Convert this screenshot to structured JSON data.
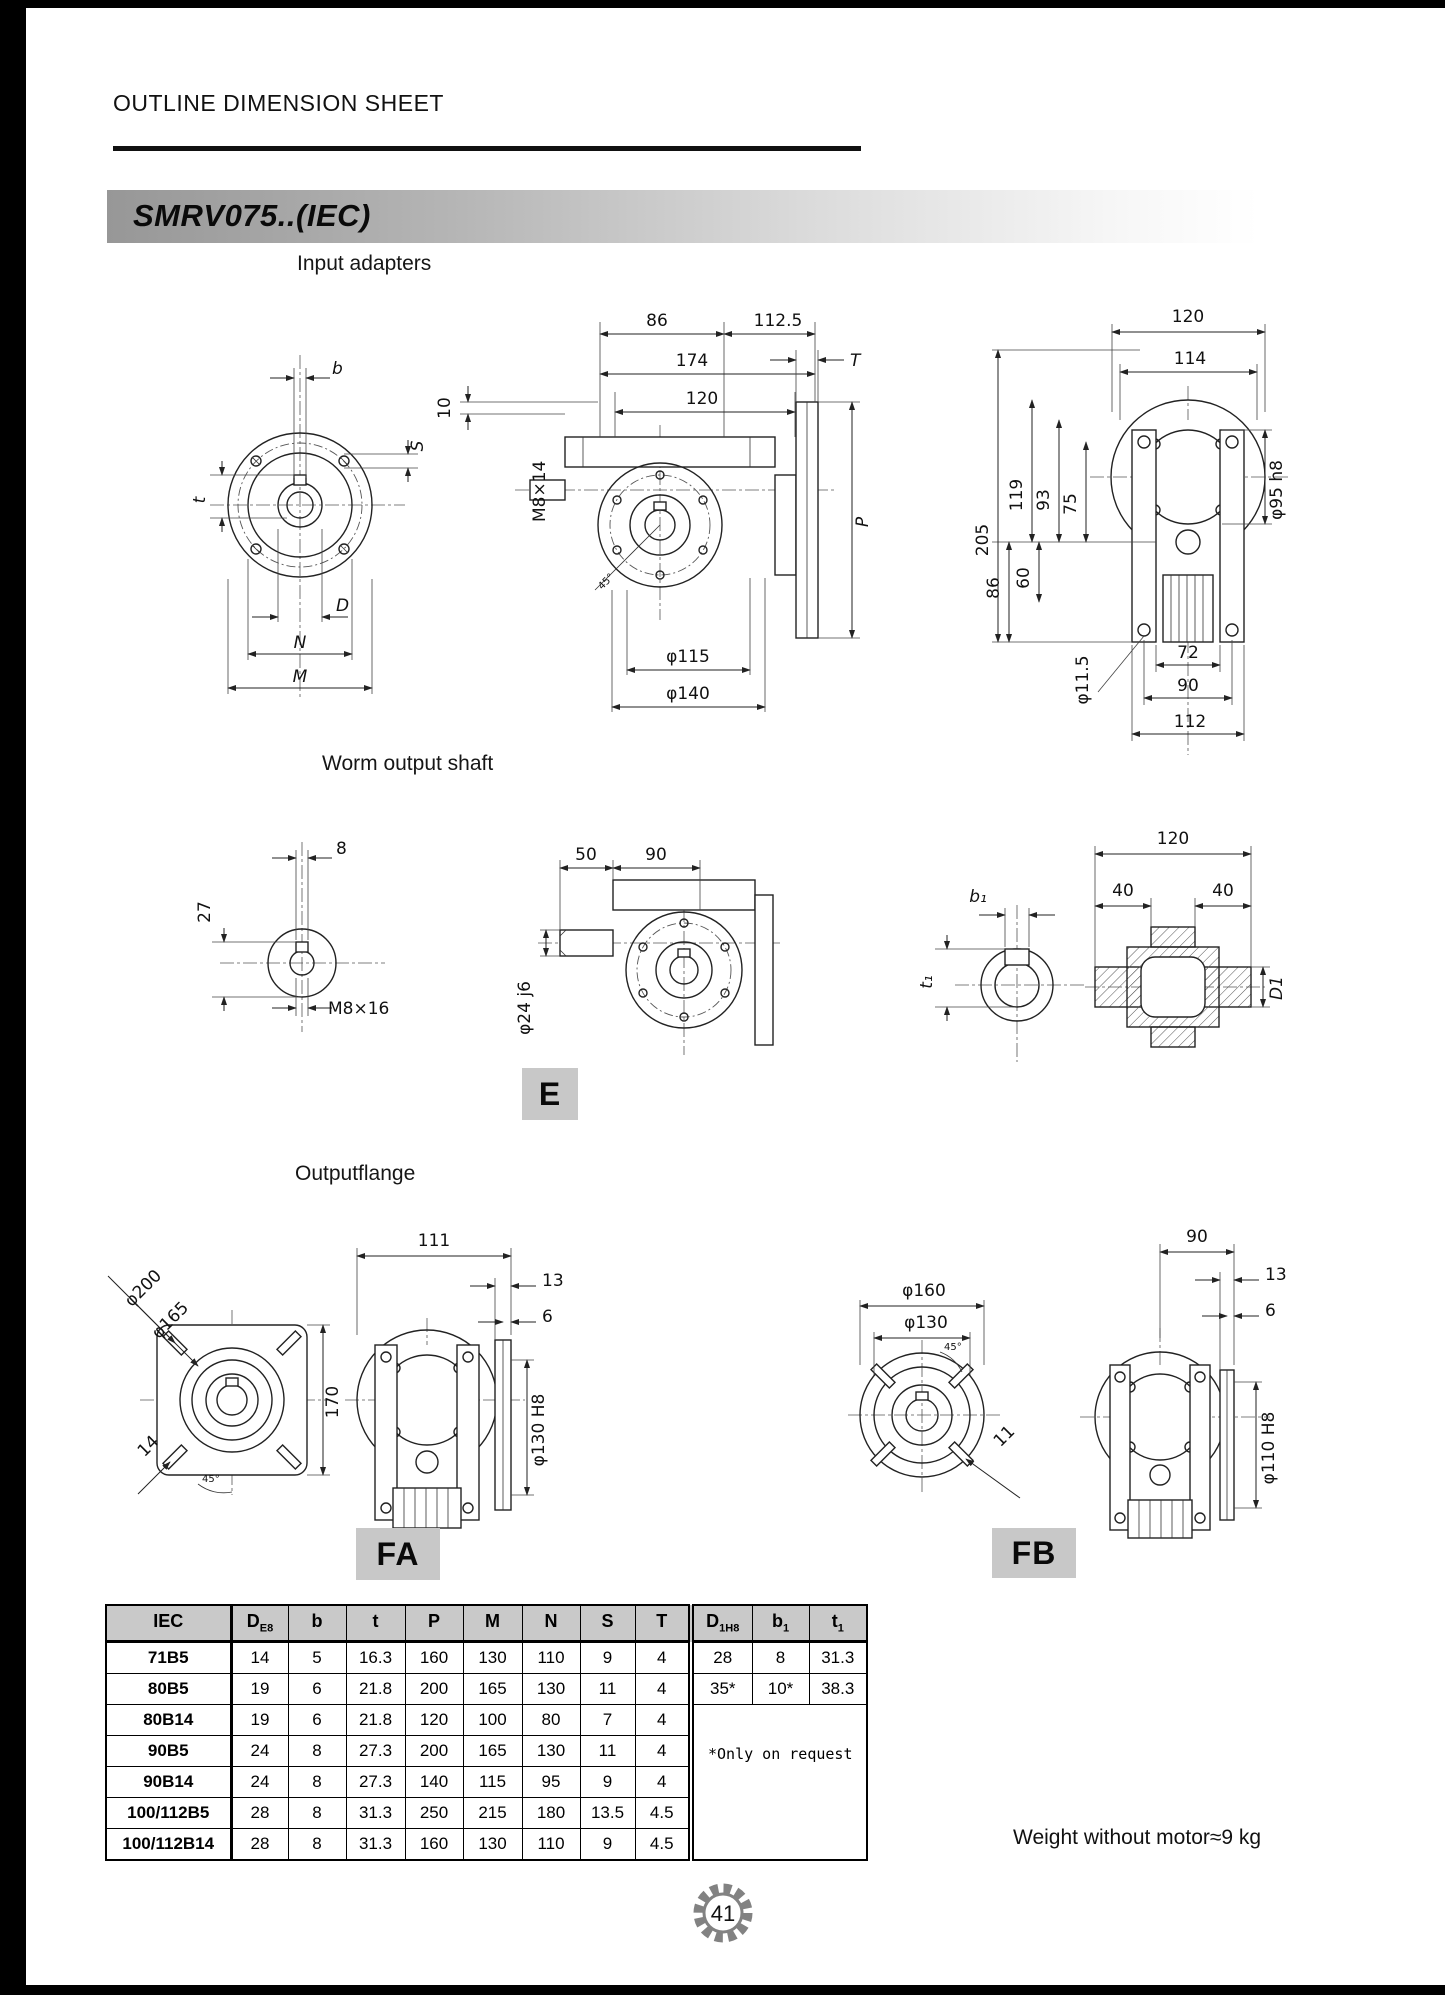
{
  "page": {
    "header_title": "OUTLINE DIMENSION SHEET",
    "model": "SMRV075..(IEC)",
    "weight_note": "Weight without motor≈9 kg",
    "page_number": "41"
  },
  "sections": {
    "input_adapters_title": "Input adapters",
    "worm_output_shaft_title": "Worm output shaft",
    "output_flange_title": "Outputflange",
    "variant_e": "E",
    "variant_fa": "FA",
    "variant_fb": "FB"
  },
  "dims": {
    "input_flange": {
      "b": "b",
      "s": "S",
      "t": "t",
      "d": "D",
      "n": "N",
      "m": "M"
    },
    "input_side": {
      "d86": "86",
      "d112_5": "112.5",
      "d174": "174",
      "d120": "120",
      "d10": "10",
      "m8x14": "M8×14",
      "t_label": "T",
      "p_label": "P",
      "phi115": "φ115",
      "phi140": "φ140",
      "deg45": "45°"
    },
    "input_front": {
      "d120": "120",
      "d114": "114",
      "d205": "205",
      "d119": "119",
      "d93": "93",
      "d75": "75",
      "d86": "86",
      "d60": "60",
      "phi95h8": "φ95 h8",
      "phi11_5": "φ11.5",
      "d72": "72",
      "d90": "90",
      "d112": "112"
    },
    "worm_end": {
      "d8": "8",
      "d27": "27",
      "m8x16": "M8×16"
    },
    "worm_side": {
      "d50": "50",
      "d90": "90",
      "phi24j6": "φ24 j6"
    },
    "worm_bore": {
      "b1": "b₁",
      "t1": "t₁",
      "d120": "120",
      "d40l": "40",
      "d40r": "40",
      "d1": "D1"
    },
    "out_square": {
      "phi200": "φ200",
      "phi165": "φ165",
      "d170": "170",
      "d14": "14",
      "deg45": "45°"
    },
    "out_fa": {
      "d111": "111",
      "d13": "13",
      "d6": "6",
      "phi130h8": "φ130 H8"
    },
    "out_fb_circle": {
      "phi160": "φ160",
      "phi130": "φ130",
      "d11": "11",
      "deg45": "45°"
    },
    "out_fb_side": {
      "d90": "90",
      "d13": "13",
      "d6": "6",
      "phi110h8": "φ110 H8"
    }
  },
  "table": {
    "left_headers": [
      [
        "IEC",
        ""
      ],
      [
        "D",
        "E8"
      ],
      [
        "b",
        ""
      ],
      [
        "t",
        ""
      ],
      [
        "P",
        ""
      ],
      [
        "M",
        ""
      ],
      [
        "N",
        ""
      ],
      [
        "S",
        ""
      ],
      [
        "T",
        ""
      ]
    ],
    "right_headers": [
      [
        "D",
        "1H8"
      ],
      [
        "b",
        "1"
      ],
      [
        "t",
        "1"
      ]
    ],
    "rows": [
      [
        "71B5",
        "14",
        "5",
        "16.3",
        "160",
        "130",
        "110",
        "9",
        "4"
      ],
      [
        "80B5",
        "19",
        "6",
        "21.8",
        "200",
        "165",
        "130",
        "11",
        "4"
      ],
      [
        "80B14",
        "19",
        "6",
        "21.8",
        "120",
        "100",
        "80",
        "7",
        "4"
      ],
      [
        "90B5",
        "24",
        "8",
        "27.3",
        "200",
        "165",
        "130",
        "11",
        "4"
      ],
      [
        "90B14",
        "24",
        "8",
        "27.3",
        "140",
        "115",
        "95",
        "9",
        "4"
      ],
      [
        "100/112B5",
        "28",
        "8",
        "31.3",
        "250",
        "215",
        "180",
        "13.5",
        "4.5"
      ],
      [
        "100/112B14",
        "28",
        "8",
        "31.3",
        "160",
        "130",
        "110",
        "9",
        "4.5"
      ]
    ],
    "right_rows": [
      [
        "28",
        "8",
        "31.3"
      ],
      [
        "35*",
        "10*",
        "38.3"
      ]
    ],
    "note": "*Only on request"
  }
}
